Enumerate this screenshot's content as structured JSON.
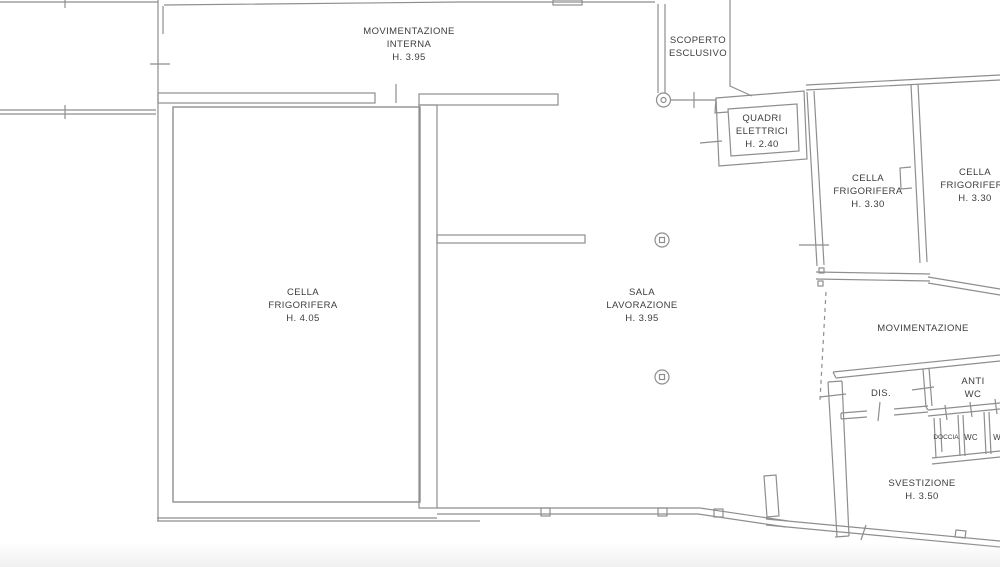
{
  "drawing_title": "",
  "colors": {
    "line": "#8e8e8e",
    "text": "#3d3d3d",
    "background": "#ffffff"
  },
  "rooms": {
    "movimentazione_interna": {
      "lines": [
        "MOVIMENTAZIONE",
        "INTERNA",
        "H. 3.95"
      ]
    },
    "scoperto_esclusivo": {
      "lines": [
        "SCOPERTO",
        "ESCLUSIVO"
      ]
    },
    "quadri_elettrici": {
      "lines": [
        "QUADRI",
        "ELETTRICI",
        "H. 2.40"
      ]
    },
    "cella_frigorifera_grande": {
      "lines": [
        "CELLA",
        "FRIGORIFERA",
        "H. 4.05"
      ]
    },
    "sala_lavorazione": {
      "lines": [
        "SALA",
        "LAVORAZIONE",
        "H. 3.95"
      ]
    },
    "cella_frigorifera_1": {
      "lines": [
        "CELLA",
        "FRIGORIFERA",
        "H. 3.30"
      ]
    },
    "cella_frigorifera_2": {
      "lines": [
        "CELLA",
        "FRIGORIFERA",
        "H. 3.30"
      ]
    },
    "movimentazione": {
      "lines": [
        "MOVIMENTAZIONE"
      ]
    },
    "dis": {
      "lines": [
        "DIS."
      ]
    },
    "anti_wc": {
      "lines": [
        "ANTI",
        "WC"
      ]
    },
    "doccia": {
      "lines": [
        "DOCCIA"
      ]
    },
    "wc_1": {
      "lines": [
        "WC"
      ]
    },
    "wc_2": {
      "lines": [
        "WC"
      ]
    },
    "svestizione": {
      "lines": [
        "SVESTIZIONE",
        "H. 3.50"
      ]
    }
  }
}
